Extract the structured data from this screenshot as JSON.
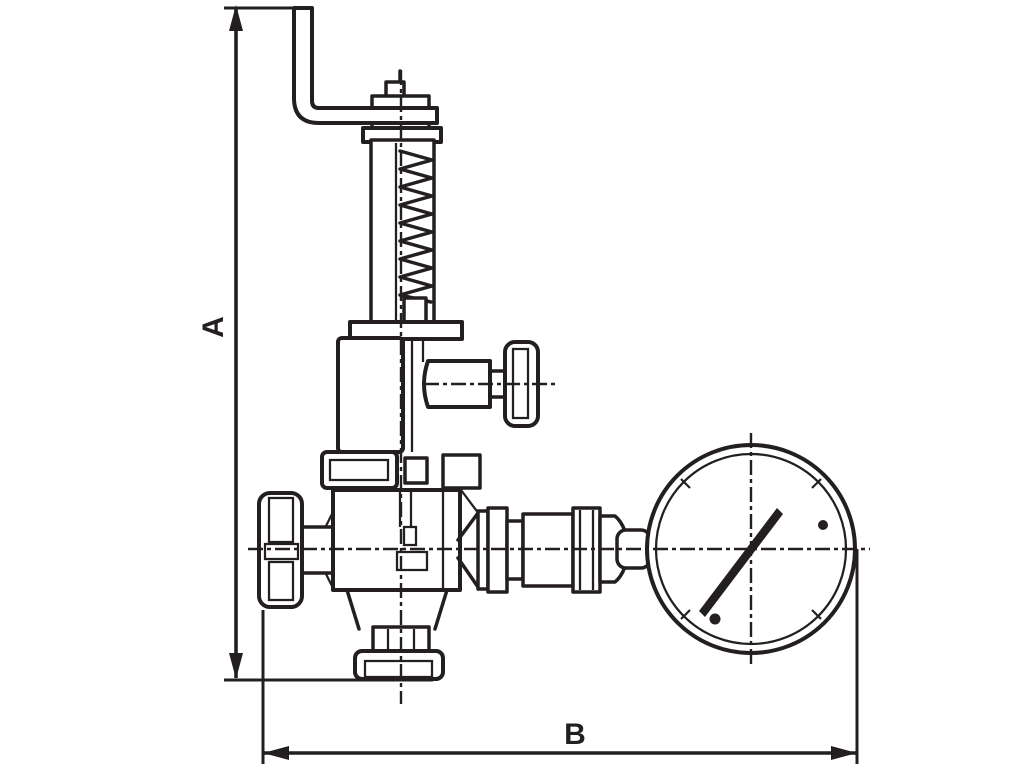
{
  "drawing": {
    "background": "#ffffff",
    "stroke_color": "#231f20",
    "labels": {
      "a": "A",
      "b": "B"
    }
  }
}
